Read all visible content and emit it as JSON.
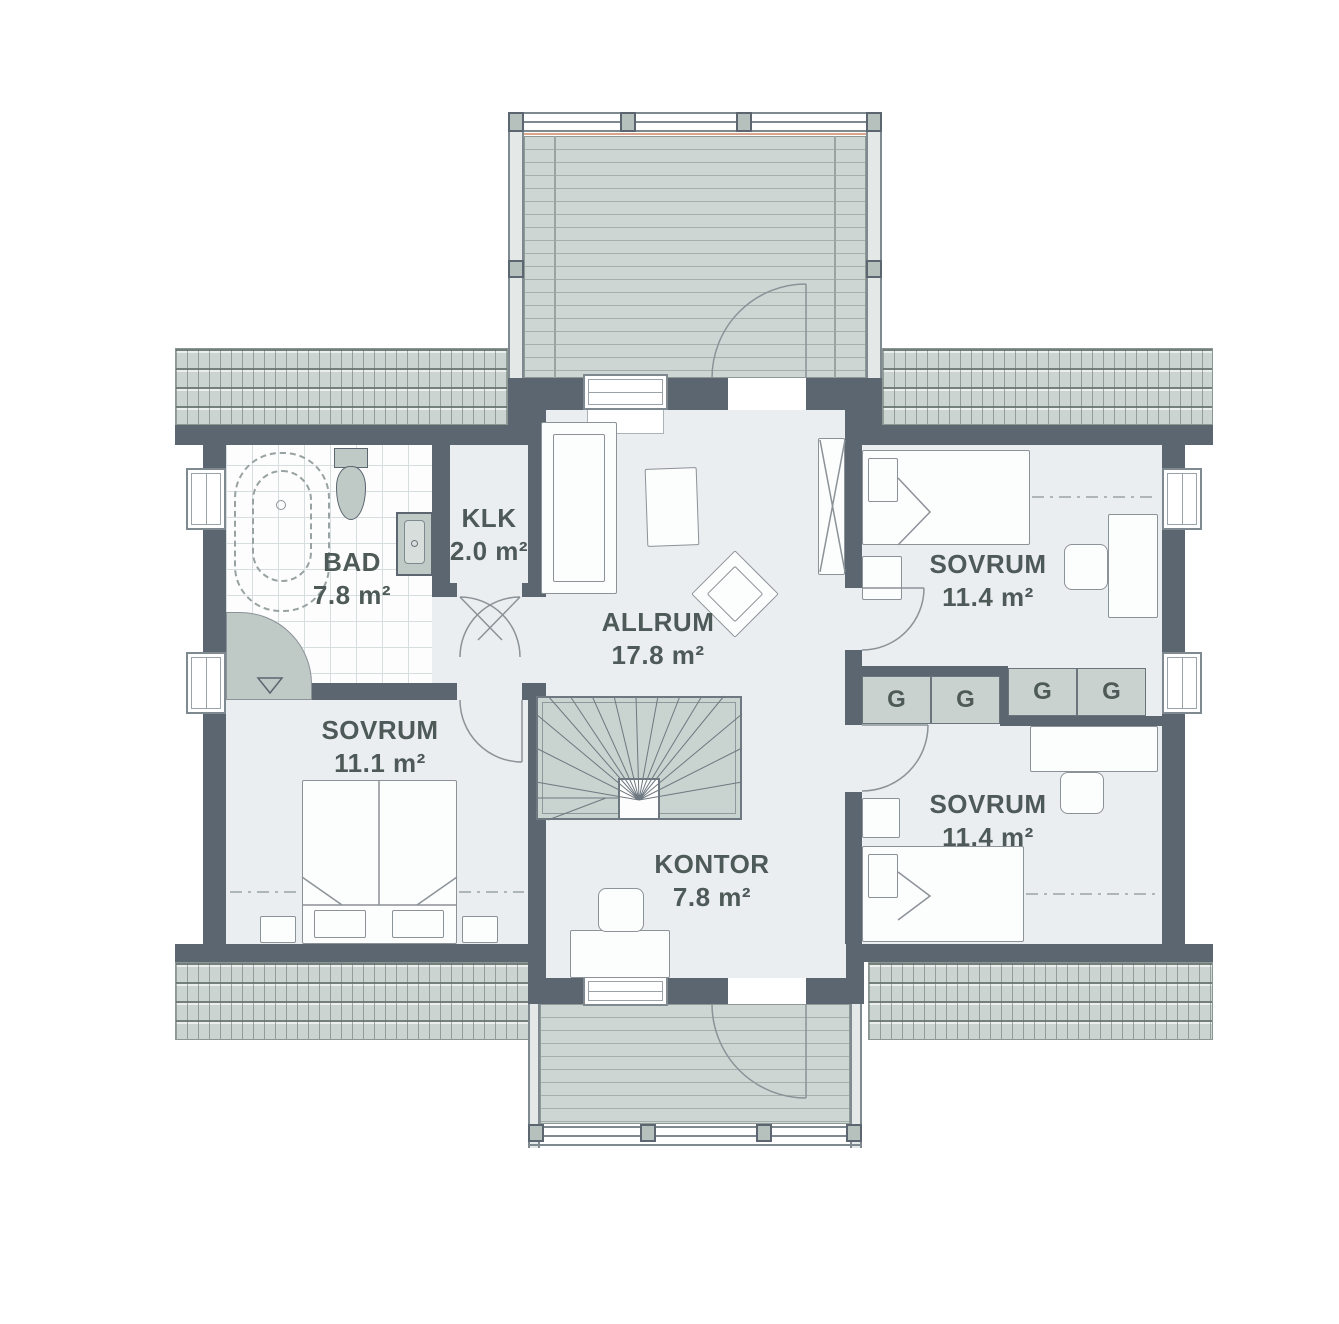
{
  "rooms": {
    "bad": {
      "name": "BAD",
      "area": "7.8 m²"
    },
    "klk": {
      "name": "KLK",
      "area": "2.0 m²"
    },
    "allrum": {
      "name": "ALLRUM",
      "area": "17.8 m²"
    },
    "kontor": {
      "name": "KONTOR",
      "area": "7.8 m²"
    },
    "sovrum_left": {
      "name": "SOVRUM",
      "area": "11.1 m²"
    },
    "sovrum_top_right": {
      "name": "SOVRUM",
      "area": "11.4 m²"
    },
    "sovrum_bottom_right": {
      "name": "SOVRUM",
      "area": "11.4 m²"
    }
  },
  "wardrobes": {
    "label": "G",
    "count": 4
  },
  "symbols": {
    "shower_drain": "▽"
  },
  "colors": {
    "wall": "#5b6670",
    "floor": "#ebeef0",
    "roof": "#cbd4d0",
    "deck": "#cdd6d2",
    "fixture": "#bfc9c5",
    "wardrobe": "#c9d2ce",
    "line": "#8b9298",
    "text": "#4e5a57",
    "accent": "#d9a58b"
  }
}
